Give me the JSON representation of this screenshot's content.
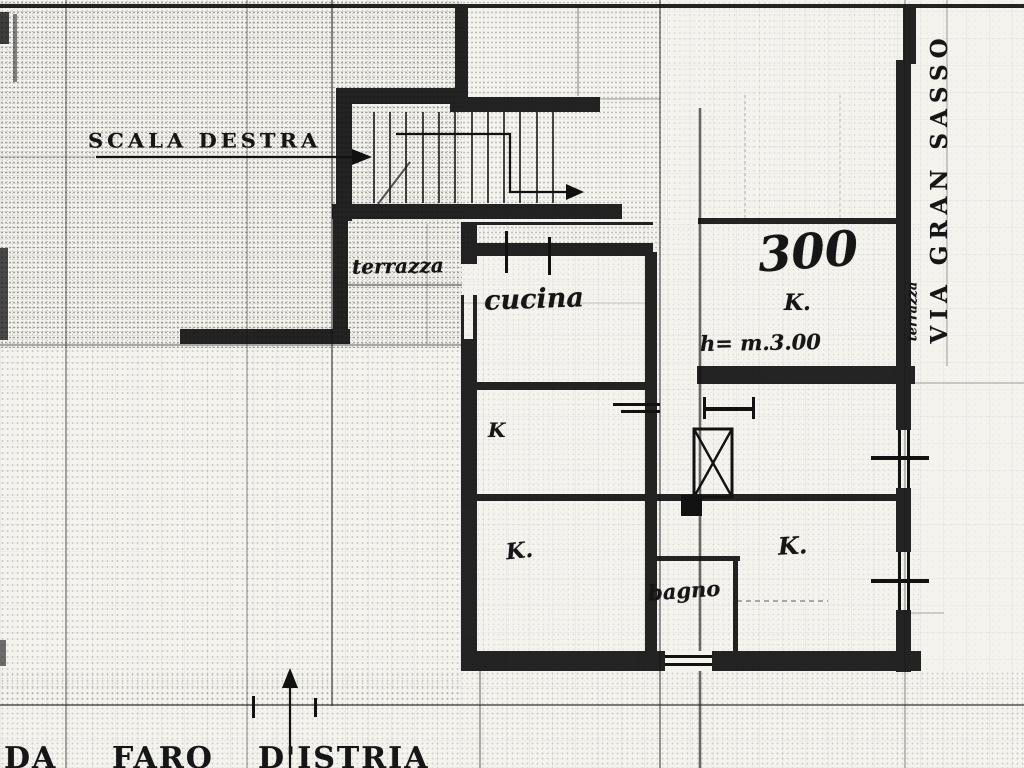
{
  "meta": {
    "document_type": "Scanned cadastral floor plan (planimetria)"
  },
  "annotations": {
    "stair_label": "SCALA DESTRA",
    "apartment_number": "300",
    "ceiling_height_note": "h= m.3.00",
    "street_right_vertical": "VIA GRAN SASSO",
    "street_bottom_words": [
      "DA",
      "FARO",
      "D'ISTRIA"
    ]
  },
  "rooms": {
    "terrazza_upper": "terrazza",
    "cucina": "cucina",
    "k_mid_left": "K",
    "k_lower_left": "K.",
    "k_upper_right": "K.",
    "k_lower_right": "K.",
    "bagno": "bagno",
    "terrazza_right_vertical": "terrazza"
  },
  "colors": {
    "paper": "#f4f3ee",
    "ink": "#161616"
  }
}
